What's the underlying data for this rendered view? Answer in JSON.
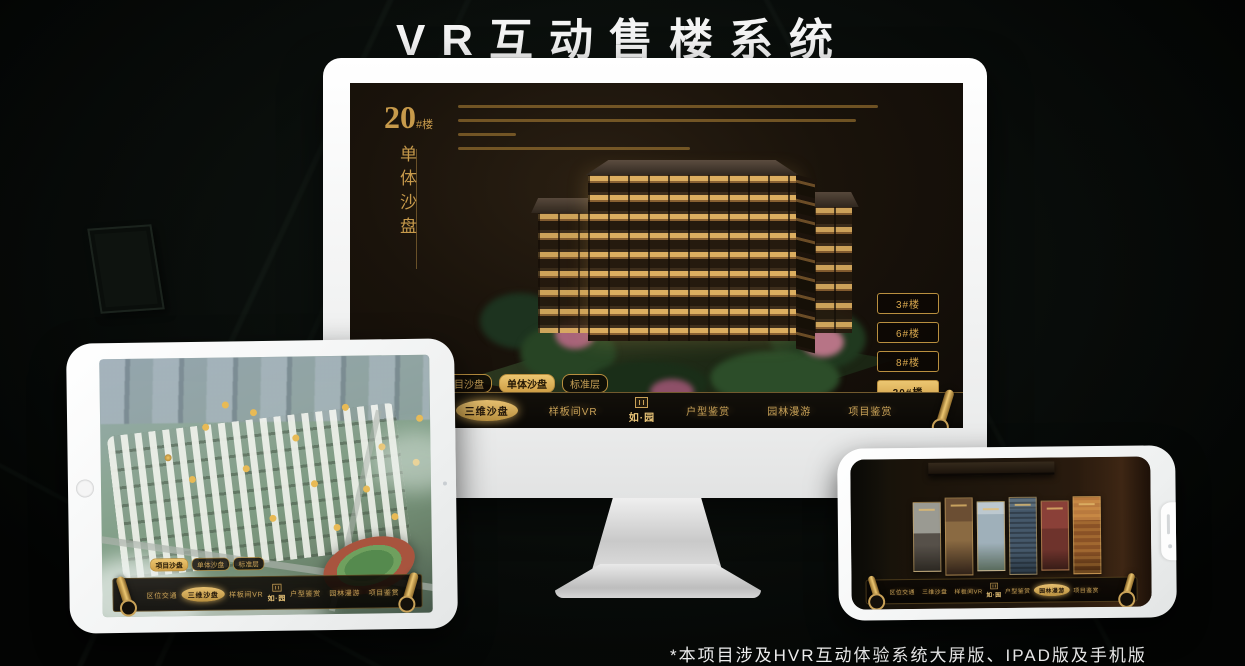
{
  "page": {
    "title": "VR互动售楼系统",
    "footnote": "*本项目涉及HVR互动体验系统大屏版、IPAD版及手机版"
  },
  "colors": {
    "gold": "#c79a4b",
    "gold_bright": "#ecc671",
    "selected_fill": "#d9a84e",
    "screen_bg": "#1a130b"
  },
  "monitor": {
    "floor_heading": {
      "number": "20",
      "suffix": "#楼",
      "subtitle": "单体沙盘"
    },
    "floor_buttons": [
      {
        "label": "3#楼",
        "selected": false
      },
      {
        "label": "6#楼",
        "selected": false
      },
      {
        "label": "8#楼",
        "selected": false
      },
      {
        "label": "20#楼",
        "selected": true
      }
    ],
    "tabs": [
      {
        "label": "项目沙盘",
        "selected": false
      },
      {
        "label": "单体沙盘",
        "selected": true
      },
      {
        "label": "标准层",
        "selected": false
      }
    ],
    "nav": {
      "left": [
        {
          "label": "区位交通",
          "selected": false
        },
        {
          "label": "三维沙盘",
          "selected": true
        },
        {
          "label": "样板间VR",
          "selected": false
        }
      ],
      "logo": "如·园",
      "right": [
        {
          "label": "户型鉴赏",
          "selected": false
        },
        {
          "label": "园林漫游",
          "selected": false
        },
        {
          "label": "项目鉴赏",
          "selected": false
        }
      ]
    }
  },
  "tablet": {
    "tabs": [
      {
        "label": "项目沙盘",
        "selected": true
      },
      {
        "label": "单体沙盘",
        "selected": false
      },
      {
        "label": "标准层",
        "selected": false
      }
    ],
    "nav": {
      "left": [
        {
          "label": "区位交通",
          "selected": false
        },
        {
          "label": "三维沙盘",
          "selected": true
        },
        {
          "label": "样板间VR",
          "selected": false
        }
      ],
      "logo": "如·园",
      "right": [
        {
          "label": "户型鉴赏",
          "selected": false
        },
        {
          "label": "园林漫游",
          "selected": false
        },
        {
          "label": "项目鉴赏",
          "selected": false
        }
      ]
    }
  },
  "phone": {
    "nav": {
      "left": [
        {
          "label": "区位交通",
          "selected": false
        },
        {
          "label": "三维沙盘",
          "selected": false
        },
        {
          "label": "样板间VR",
          "selected": false
        }
      ],
      "logo": "如·园",
      "right": [
        {
          "label": "户型鉴赏",
          "selected": false
        },
        {
          "label": "园林漫游",
          "selected": true
        },
        {
          "label": "项目鉴赏",
          "selected": false
        }
      ]
    }
  }
}
